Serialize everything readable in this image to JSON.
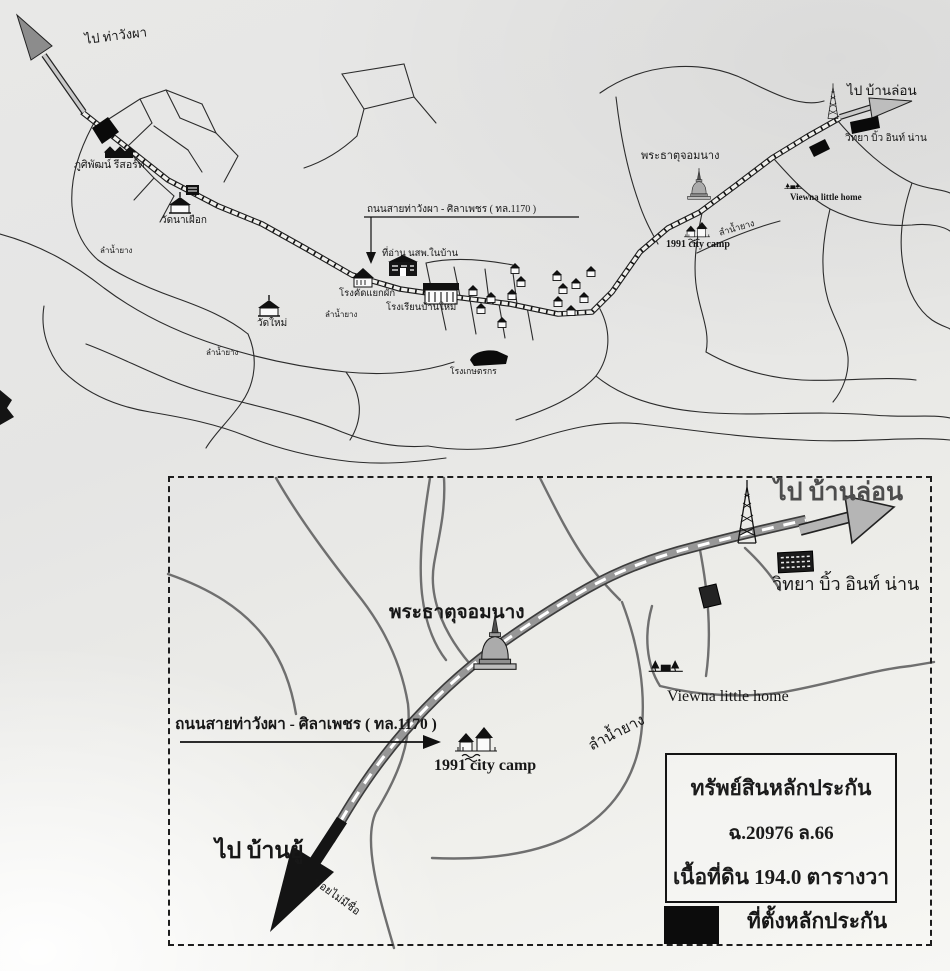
{
  "colors": {
    "ink": "#1f1f1f",
    "road_gray": "#969696",
    "paper": "#ebebea",
    "marker_black": "#0d0d0d"
  },
  "overview_map": {
    "dest_northwest": "ไป ท่าวังผา",
    "dest_northeast": "ไป บ้านล่อน",
    "road_label": "ถนนสายท่าวังผา - ศิลาเพชร ( ทล.1170 )",
    "stream_label": "ลำน้ำยาง",
    "places": {
      "resort": "ภูศิพัฒน์ รีสอร์ท",
      "wat_na_phueak": "วัดนาเผือก",
      "wat_mai": "วัดใหม่",
      "reading_hut": "ที่อ่าน นสพ.ในบ้าน",
      "vegetable_sorting_plant": "โรงคัดแยกผัก",
      "school": "โรงเรียนบ้านใหม่",
      "farmer_building": "โรงเกษตรกร",
      "phra_that_chom_nang": "พระธาตุจอมนาง",
      "city_camp_1991": "1991 city camp",
      "viewna_little_home": "Viewna little home",
      "wittaya_biew_in_nan": "วิทยา บิ้ว อินท์ น่าน"
    }
  },
  "detail_map": {
    "dest_northeast": "ไป บ้านล่อน",
    "dest_southwest": "ไป บ้านยู้",
    "road_label": "ถนนสายท่าวังผา - ศิลาเพชร ( ทล.1170 )",
    "stream_label": "ลำน้ำยาง",
    "unnamed_alley": "ซอยไม่มีชื่อ",
    "places": {
      "phra_that_chom_nang": "พระธาตุจอมนาง",
      "city_camp_1991": "1991 city camp",
      "viewna_little_home": "Viewna little home",
      "wittaya_biew_in_nan": "วิทยา บิ้ว อินท์ น่าน"
    },
    "info_box": {
      "title": "ทรัพย์สินหลักประกัน",
      "deed_no": "ฉ.20976 ล.66",
      "land_area": "เนื้อที่ดิน 194.0 ตารางวา"
    },
    "legend": {
      "collateral_location": "ที่ตั้งหลักประกัน"
    }
  }
}
